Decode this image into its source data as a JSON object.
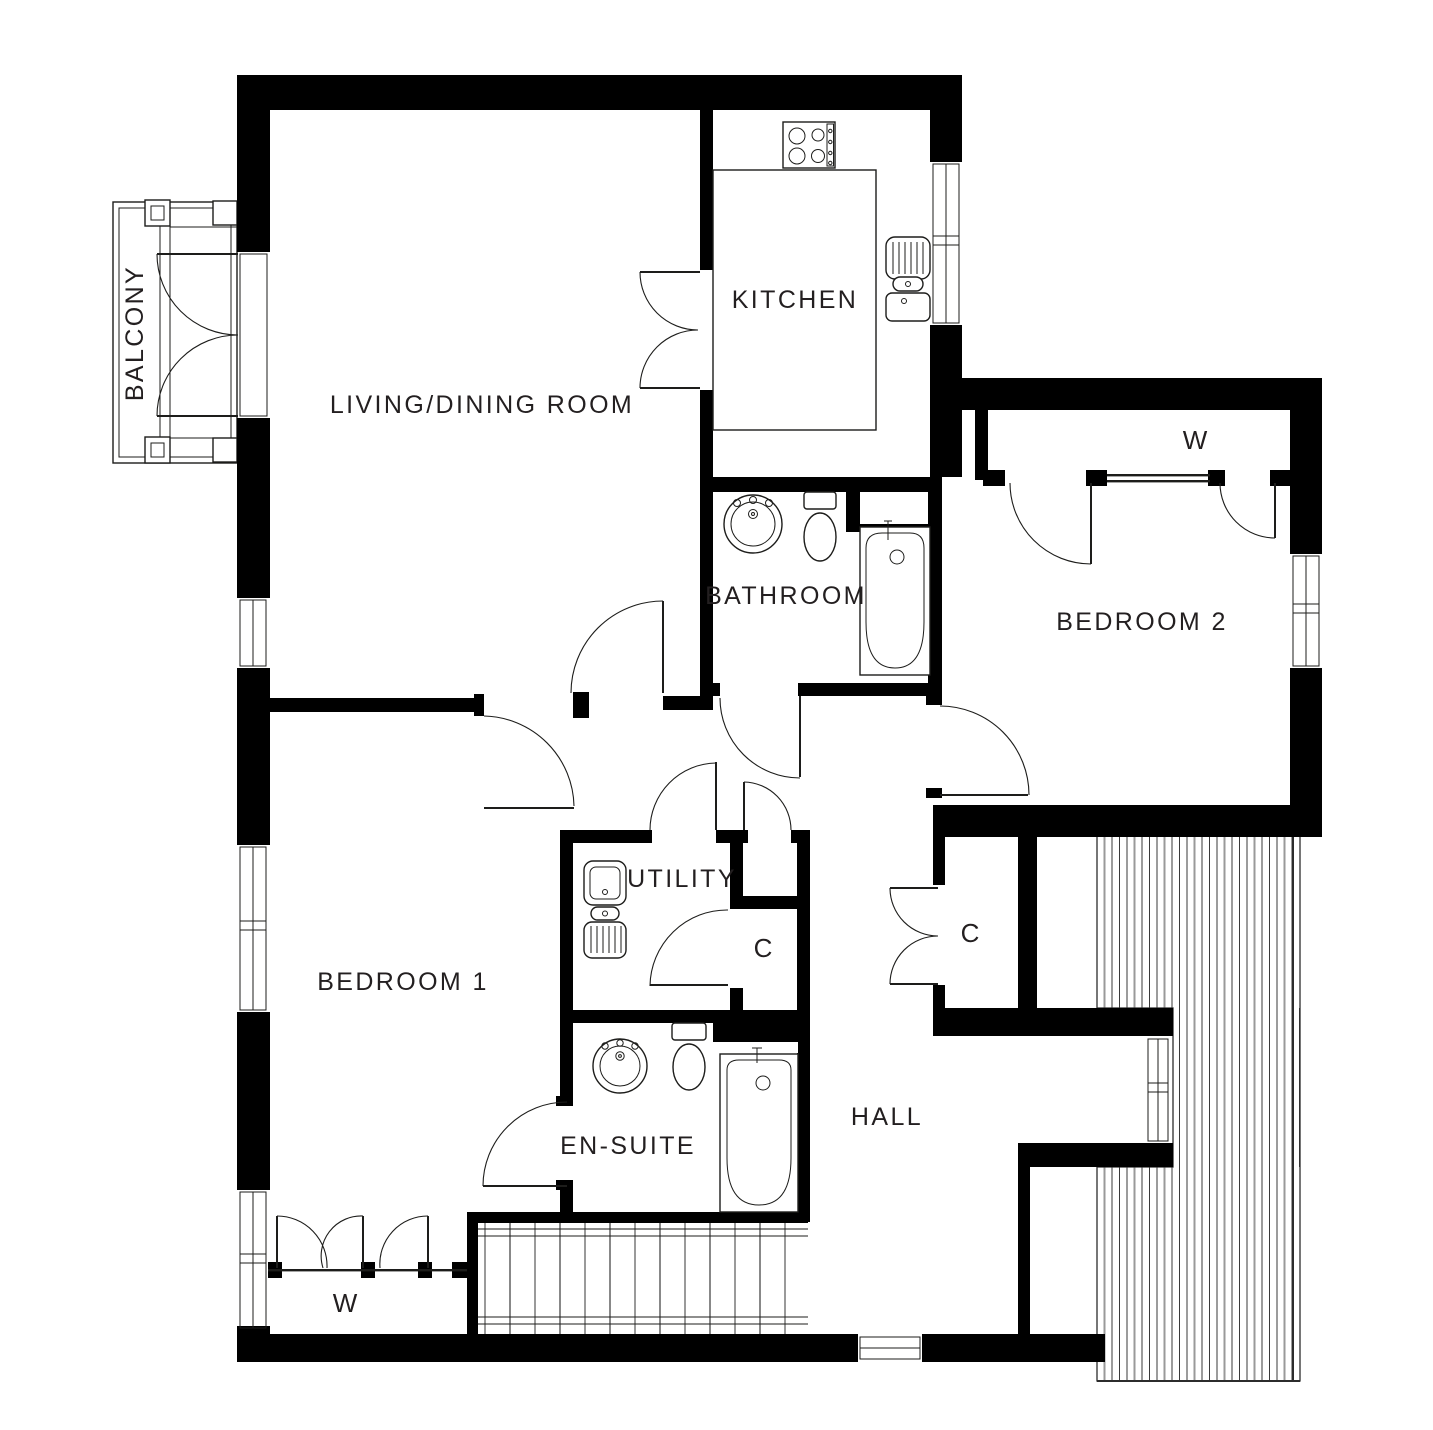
{
  "plan": {
    "rooms": {
      "balcony": {
        "label": "BALCONY"
      },
      "living_dining": {
        "label": "LIVING/DINING ROOM"
      },
      "kitchen": {
        "label": "KITCHEN"
      },
      "bathroom": {
        "label": "BATHROOM"
      },
      "bedroom2": {
        "label": "BEDROOM 2",
        "wardrobe_label": "W"
      },
      "bedroom1": {
        "label": "BEDROOM 1",
        "wardrobe_label": "W"
      },
      "utility": {
        "label": "UTILITY"
      },
      "closet_utility": {
        "label": "C"
      },
      "closet_hall": {
        "label": "C"
      },
      "ensuite": {
        "label": "EN-SUITE"
      },
      "hall": {
        "label": "HALL"
      }
    },
    "colors": {
      "wall": "#000000",
      "line": "#1d1d1b",
      "text": "#231f20",
      "deck_line": "#3a3a3a",
      "deck_line_light": "#9a9a9a",
      "background": "#ffffff"
    }
  }
}
